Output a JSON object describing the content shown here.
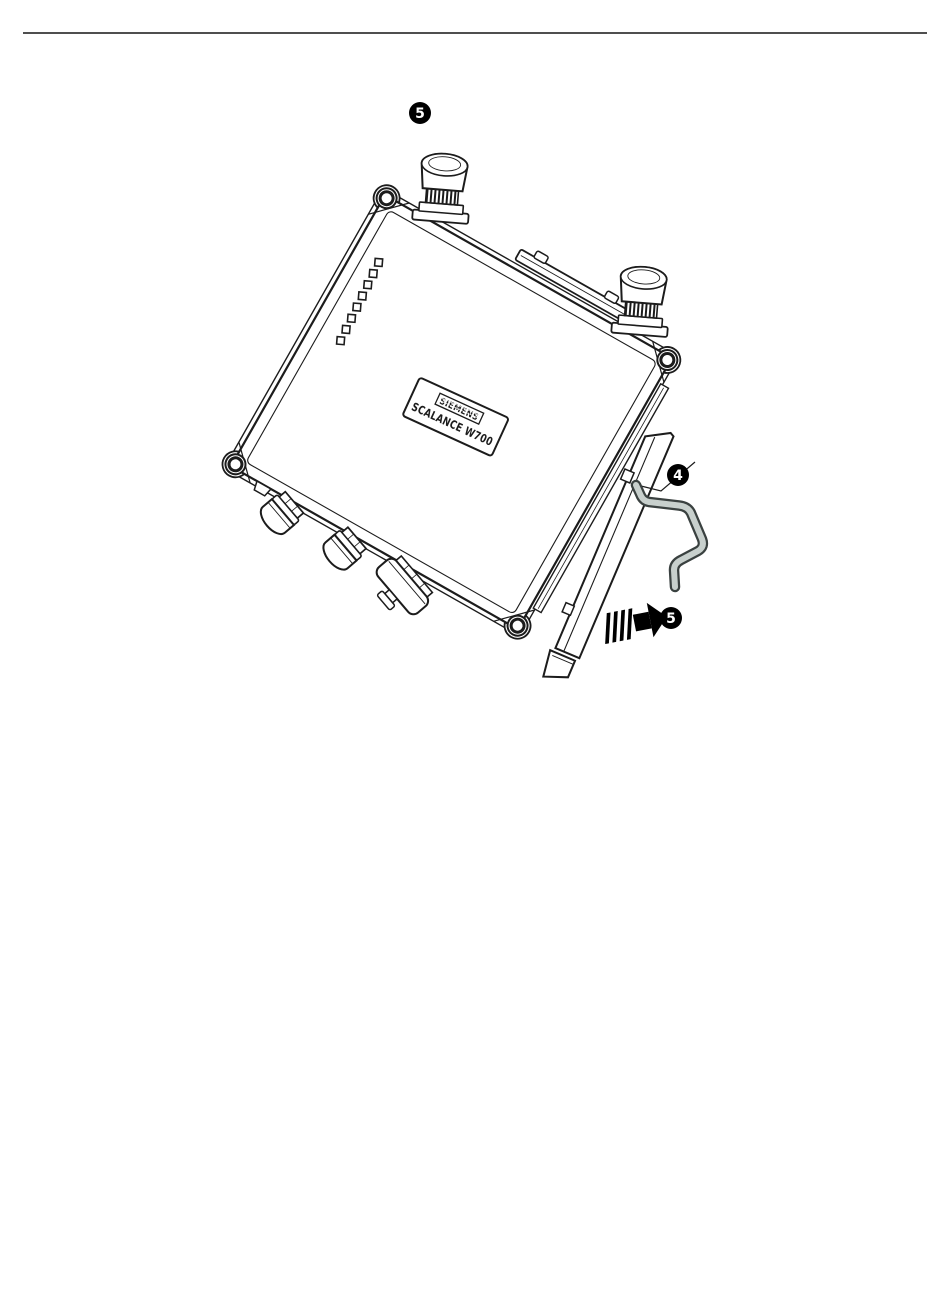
{
  "page": {
    "width": 950,
    "height": 1301,
    "background": "#ffffff"
  },
  "device_label": {
    "brand": "SIEMENS",
    "model": "SCALANCE W700"
  },
  "callouts": {
    "top": "5",
    "clip": "4",
    "slide": "5"
  },
  "colors": {
    "line": "#1c1c1c",
    "clip_fill": "#c8d0cd",
    "clip_stroke": "#3a4140",
    "arrow": "#000000",
    "badge_bg": "#000000",
    "badge_text": "#ffffff",
    "rule": "#4f4f4f"
  }
}
